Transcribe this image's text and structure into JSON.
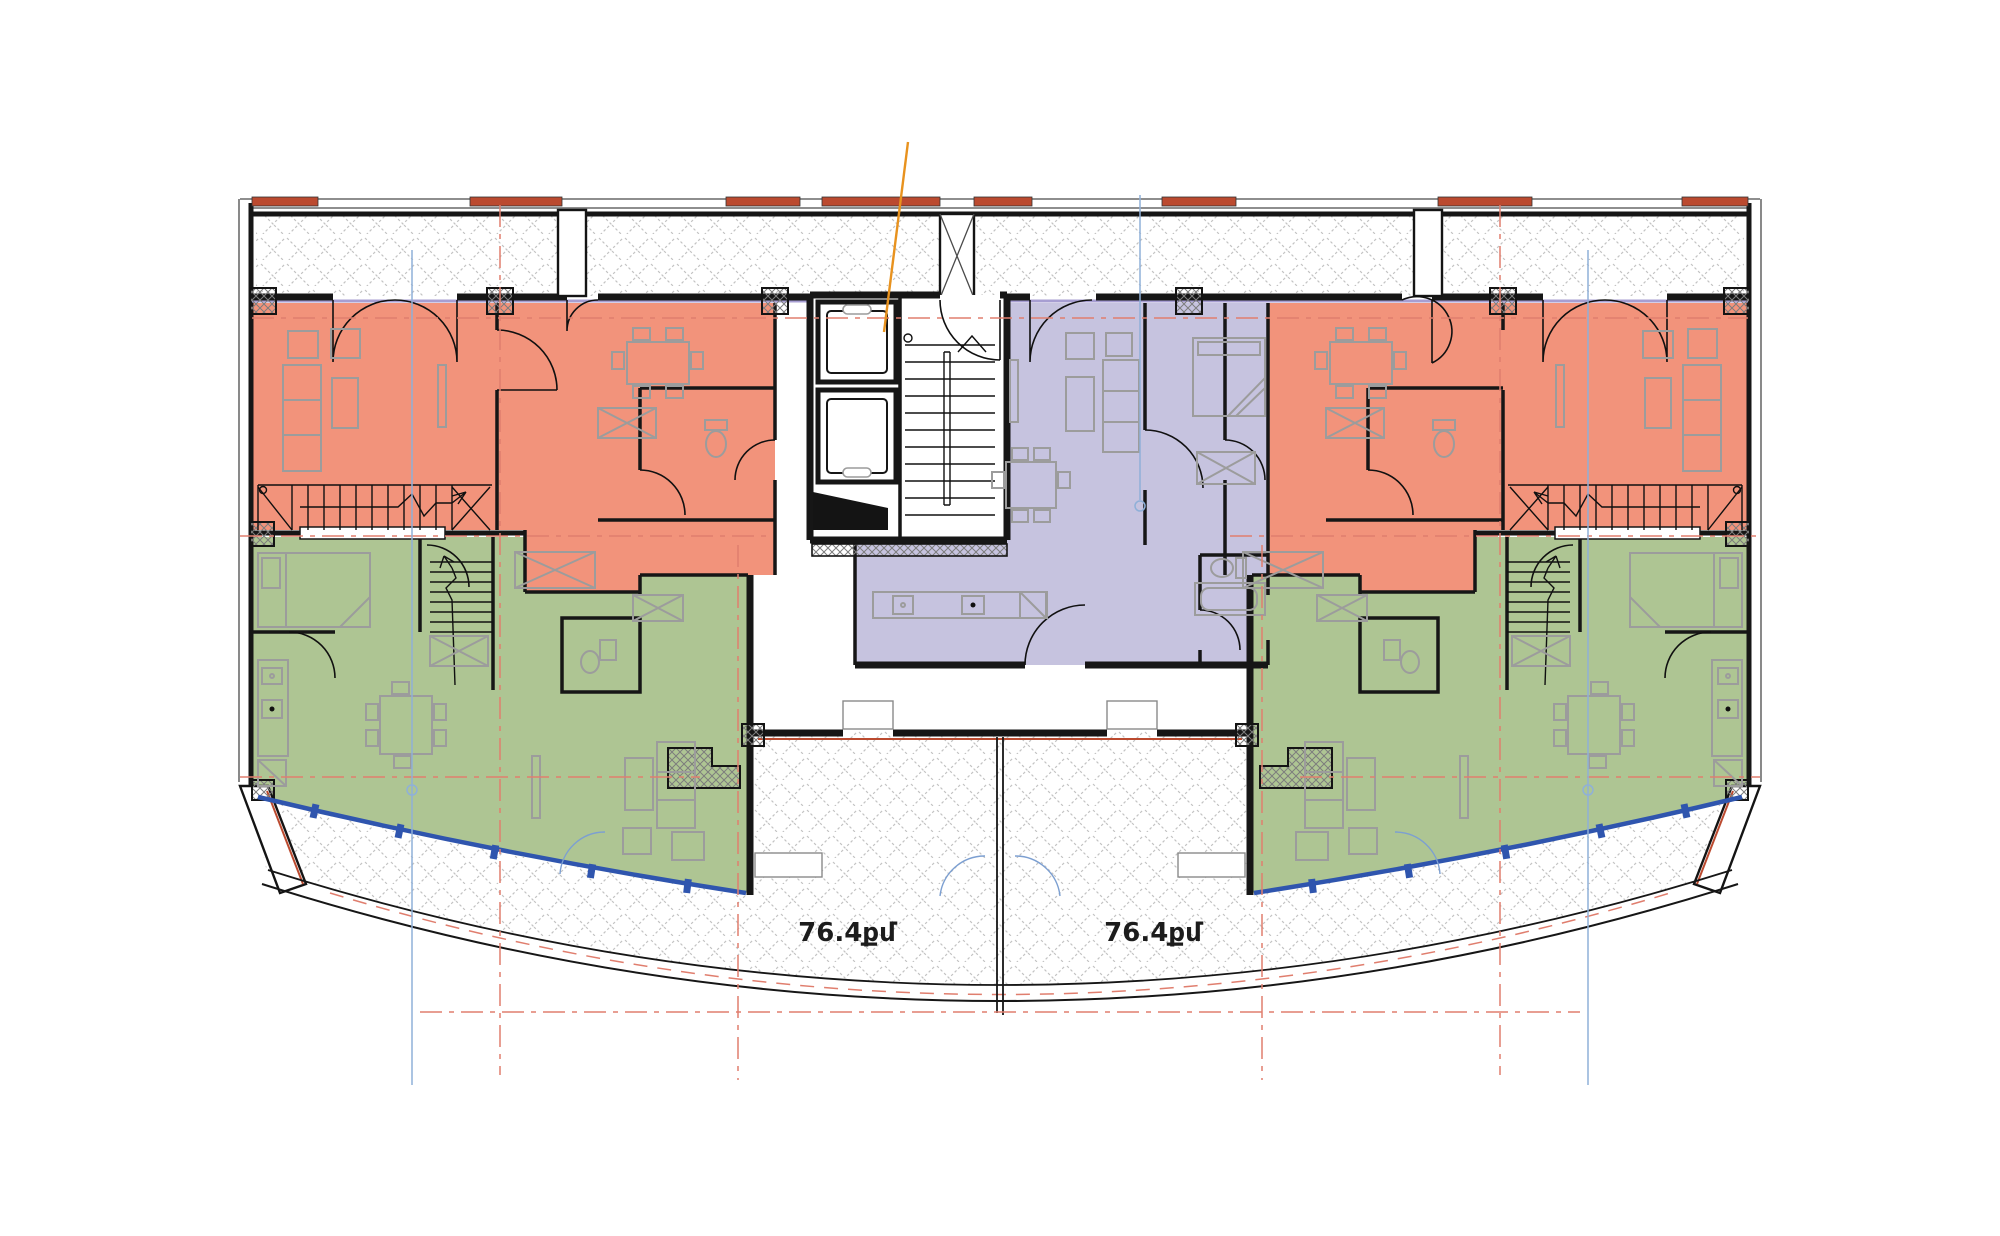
{
  "title": "residential-floor-plan",
  "labels": {
    "terrace_left_area": "76.4քմ",
    "terrace_right_area": "76.4քմ"
  },
  "colors": {
    "apartment_salmon": "#F2937B",
    "apartment_green": "#AEC593",
    "apartment_purple": "#C6C3DF",
    "wall": "#161616",
    "furniture": "#9C9C9C",
    "glazing_blue": "#2F55AE",
    "centerline_red": "#E07E6E",
    "centerline_blue": "#8FB0D8",
    "leader_orange": "#E8921E",
    "accent_red": "#BB4A2F",
    "hatch": "#C3C3C3"
  }
}
